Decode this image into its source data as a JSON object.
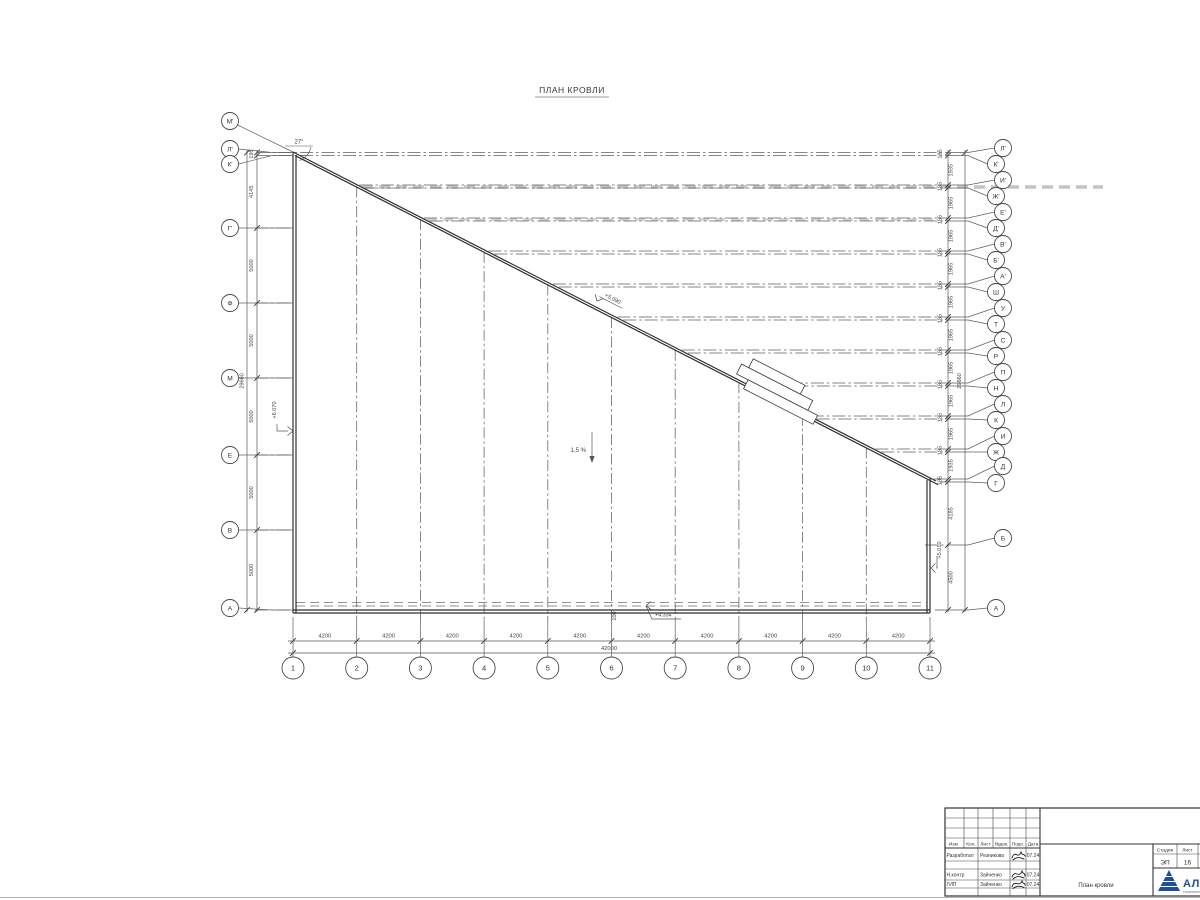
{
  "title": "ПЛАН КРОВЛИ",
  "annotations": {
    "angle": "27°",
    "slope": "1,5 %",
    "dim_100": "100",
    "elev_left": "+6.070",
    "elev_diag": "+5.090",
    "elev_right": "+5.010",
    "elev_bottom": "+4.334"
  },
  "axes": {
    "left": {
      "markers": [
        {
          "label": "М'",
          "cy": 121,
          "y": null
        },
        {
          "label": "Л'",
          "cy": 149,
          "y": 152.5
        },
        {
          "label": "К'",
          "cy": 164,
          "y": 155.5
        },
        {
          "label": "Г'",
          "cy": 228,
          "y": 228
        },
        {
          "label": "Ф",
          "cy": 303,
          "y": 303
        },
        {
          "label": "М",
          "cy": 378,
          "y": 378
        },
        {
          "label": "Е",
          "cy": 455,
          "y": 455
        },
        {
          "label": "В",
          "cy": 530,
          "y": 530
        },
        {
          "label": "А",
          "cy": 608,
          "y": 610
        }
      ],
      "gaps": [
        "195",
        "4145",
        "5000",
        "5000",
        "5000",
        "5000",
        "5000"
      ],
      "total": "29660"
    },
    "right": {
      "markers": [
        {
          "label": "Л'",
          "cy": 148,
          "y": 152.5
        },
        {
          "label": "К'",
          "cy": 164,
          "y": 155.5
        },
        {
          "label": "И'",
          "cy": 180,
          "y": 185
        },
        {
          "label": "Ж'",
          "cy": 196,
          "y": 188
        },
        {
          "label": "Е'",
          "cy": 212,
          "y": 218
        },
        {
          "label": "Д'",
          "cy": 228,
          "y": 221
        },
        {
          "label": "В'",
          "cy": 244,
          "y": 251
        },
        {
          "label": "Б'",
          "cy": 260,
          "y": 254
        },
        {
          "label": "А'",
          "cy": 276,
          "y": 284
        },
        {
          "label": "Ш",
          "cy": 292,
          "y": 287
        },
        {
          "label": "У",
          "cy": 308,
          "y": 317
        },
        {
          "label": "Т",
          "cy": 324,
          "y": 320
        },
        {
          "label": "С",
          "cy": 340,
          "y": 350
        },
        {
          "label": "Р",
          "cy": 356,
          "y": 353
        },
        {
          "label": "П",
          "cy": 372,
          "y": 383
        },
        {
          "label": "Н",
          "cy": 388,
          "y": 386
        },
        {
          "label": "Л",
          "cy": 404,
          "y": 416
        },
        {
          "label": "К",
          "cy": 420,
          "y": 419
        },
        {
          "label": "И",
          "cy": 436,
          "y": 449
        },
        {
          "label": "Ж",
          "cy": 452,
          "y": 452
        },
        {
          "label": "Д",
          "cy": 466,
          "y": 479
        },
        {
          "label": "Г",
          "cy": 483,
          "y": 482
        },
        {
          "label": "Б",
          "cy": 538,
          "y": 545
        },
        {
          "label": "А",
          "cy": 608,
          "y": 610
        }
      ],
      "gaps": [
        "195",
        "1935",
        "195",
        "1965",
        "195",
        "1965",
        "195",
        "1965",
        "195",
        "1965",
        "195",
        "1965",
        "195",
        "1965",
        "195",
        "1965",
        "195",
        "1965",
        "195",
        "1935",
        "195",
        "4185",
        "4500"
      ],
      "total": "29660"
    },
    "bottom": {
      "markers": [
        {
          "label": "1",
          "x": 293
        },
        {
          "label": "2",
          "x": 356.7
        },
        {
          "label": "3",
          "x": 420.4
        },
        {
          "label": "4",
          "x": 484.1
        },
        {
          "label": "5",
          "x": 547.8
        },
        {
          "label": "6",
          "x": 611.5
        },
        {
          "label": "7",
          "x": 675.2
        },
        {
          "label": "8",
          "x": 738.9
        },
        {
          "label": "9",
          "x": 802.6
        },
        {
          "label": "10",
          "x": 866.3
        },
        {
          "label": "11",
          "x": 930
        }
      ],
      "gaps": [
        "4200",
        "4200",
        "4200",
        "4200",
        "4200",
        "4200",
        "4200",
        "4200",
        "4200",
        "4200"
      ],
      "total": "42000"
    }
  },
  "titleblock": {
    "header_cols": [
      "Изм.",
      "Кол.",
      "Лист",
      "№док.",
      "Подп.",
      "Дата"
    ],
    "rows": [
      {
        "role": "Разработал",
        "name": "Резникова",
        "date": "07.24"
      },
      {
        "role": "",
        "name": "",
        "date": ""
      },
      {
        "role": "Н.контр",
        "name": "Зайченко",
        "date": "07.24"
      },
      {
        "role": "ГИП",
        "name": "Зайченко",
        "date": "07.24"
      }
    ],
    "doc_title": "План кровли",
    "stage_label": "Стадия",
    "stage_value": "ЭП",
    "sheet_label": "Лист",
    "sheet_value": "16",
    "logo_text": "АЛЬЯНС",
    "logo_subtext": "строительная компания",
    "brand_color": "#1d4e9e"
  }
}
